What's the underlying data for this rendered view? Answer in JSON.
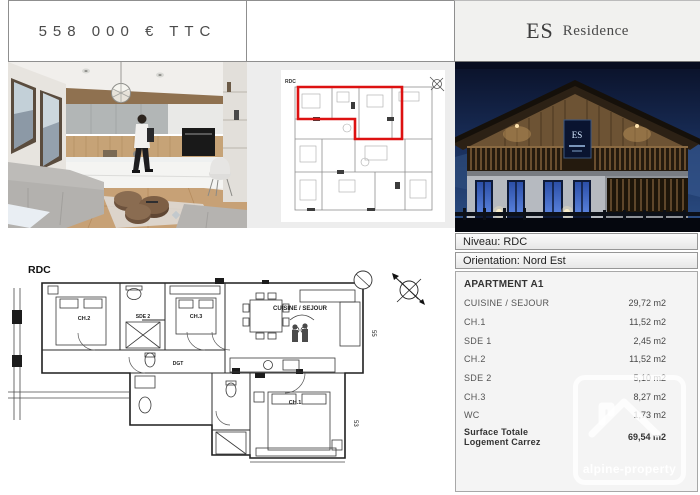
{
  "header": {
    "price": "558 000 € TTC",
    "brand": {
      "primary": "ES",
      "secondary": "Residence"
    }
  },
  "overview_plan": {
    "corner_label": "RDC",
    "highlight_color": "#dd1111"
  },
  "floor_plan": {
    "level_label": "RDC",
    "room_labels": [
      "CH.2",
      "SDE 2",
      "CH.3",
      "CUISINE / SEJOUR",
      "DGT",
      "CH.1"
    ],
    "dimension_labels": [
      "55",
      "53"
    ]
  },
  "details": {
    "niveau": "Niveau: RDC",
    "orientation": "Orientation: Nord Est",
    "apartment_title": "APARTMENT A1",
    "rooms": [
      {
        "label": "CUISINE / SEJOUR",
        "area": "29,72 m2"
      },
      {
        "label": "CH.1",
        "area": "11,52 m2"
      },
      {
        "label": "SDE 1",
        "area": "2,45 m2"
      },
      {
        "label": "CH.2",
        "area": "11,52 m2"
      },
      {
        "label": "SDE 2",
        "area": "5,10 m2"
      },
      {
        "label": "CH.3",
        "area": "8,27 m2"
      },
      {
        "label": "WC",
        "area": "1,73 m2"
      }
    ],
    "total": {
      "label": "Surface Totale Logement Carrez",
      "area": "69,54 m2"
    }
  },
  "watermark": {
    "text": "alpine-property",
    "house_icon": "⌂"
  },
  "icons": {
    "compass": "north-compass"
  },
  "colors": {
    "accent_red": "#dd1111",
    "night_sky": "#12203f",
    "panel_gray": "#ededed"
  }
}
